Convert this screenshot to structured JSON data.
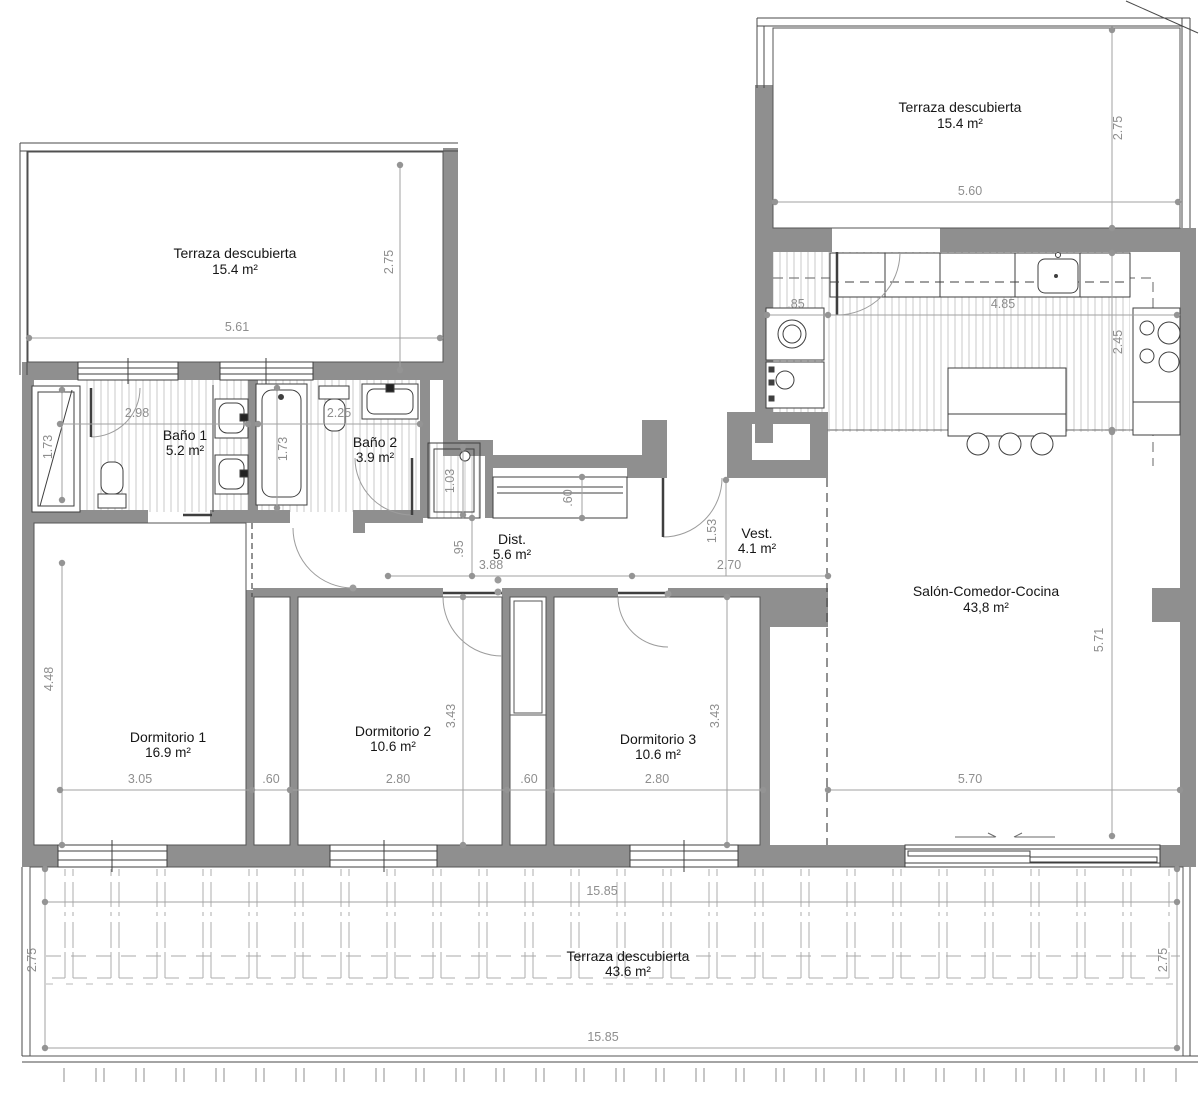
{
  "plan": {
    "type": "apartment-floor-plan",
    "colors": {
      "wall": "#8f8f8f",
      "outline": "#3f3f3f",
      "hatch": "#c9c9c9",
      "dimension": "#9e9e9e",
      "dimension_text": "#8e8e8e",
      "label_text": "#161616",
      "background": "#ffffff"
    },
    "rooms": [
      {
        "id": "terraza-top-left",
        "name": "Terraza descubierta",
        "area": "15.4 m²"
      },
      {
        "id": "terraza-top-right",
        "name": "Terraza descubierta",
        "area": "15.4 m²"
      },
      {
        "id": "bano-1",
        "name": "Baño 1",
        "area": "5.2 m²"
      },
      {
        "id": "bano-2",
        "name": "Baño 2",
        "area": "3.9 m²"
      },
      {
        "id": "distribuidor",
        "name": "Dist.",
        "area": "5.6 m²"
      },
      {
        "id": "vestibulo",
        "name": "Vest.",
        "area": "4.1 m²"
      },
      {
        "id": "salon",
        "name": "Salón-Comedor-Cocina",
        "area": "43,8 m²"
      },
      {
        "id": "dormitorio-1",
        "name": "Dormitorio 1",
        "area": "16.9 m²"
      },
      {
        "id": "dormitorio-2",
        "name": "Dormitorio 2",
        "area": "10.6 m²"
      },
      {
        "id": "dormitorio-3",
        "name": "Dormitorio 3",
        "area": "10.6 m²"
      },
      {
        "id": "terraza-bottom",
        "name": "Terraza descubierta",
        "area": "43.6 m²"
      }
    ],
    "dims": {
      "tl_width": "5.61",
      "tl_depth": "2.75",
      "tr_width": "5.60",
      "tr_depth": "2.75",
      "kitchen_left": ".85",
      "kitchen_run": "4.85",
      "kitchen_depth": "2.45",
      "bano1_width": "2.98",
      "shower1_len": "1.73",
      "bano2_width": "2.25",
      "tub_len": "1.73",
      "shower2_len": "1.03",
      "closet_depth": ".60",
      "dist_depth": ".95",
      "dist_width": "3.88",
      "vest_width": "2.70",
      "vest_depth": "1.53",
      "salon_width": "5.70",
      "salon_depth": "5.71",
      "dorm1_height": "4.48",
      "dorm1_width": "3.05",
      "closet1": ".60",
      "dorm2_width": "2.80",
      "dorm2_height": "3.43",
      "closet2": ".60",
      "dorm3_width": "2.80",
      "dorm3_height": "3.43",
      "bterr_width_top": "15.85",
      "bterr_width_bottom": "15.85",
      "bterr_depth_left": "2.75",
      "bterr_depth_right": "2.75"
    }
  }
}
